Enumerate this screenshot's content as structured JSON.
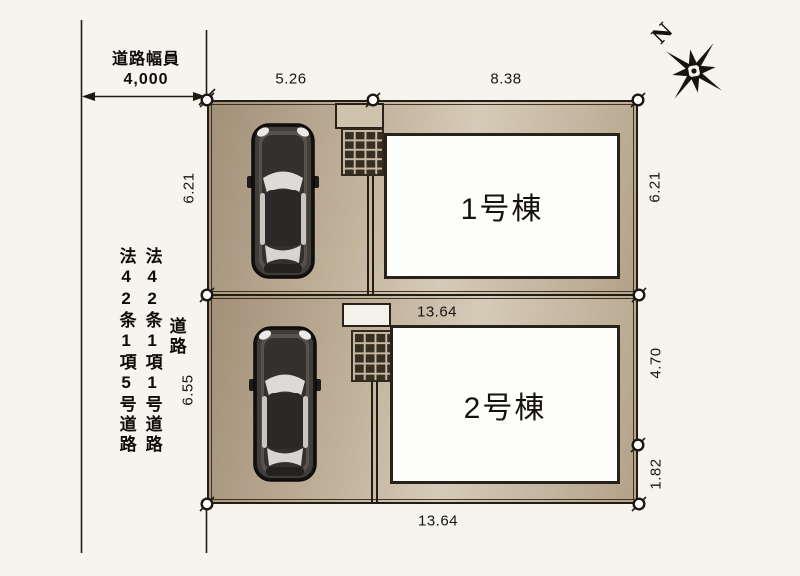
{
  "labels": {
    "road_width_caption": "道路幅員",
    "road_vertical": "道路",
    "law_note_col1": "法42条1項5号道路",
    "law_note_col2": "法42条1項1号道路",
    "building1": "1号棟",
    "building2": "2号棟",
    "north": "N"
  },
  "dimensions": {
    "road_width": "4,000",
    "top_left": "5.26",
    "top_right": "8.38",
    "lot1_left": "6.21",
    "lot1_right": "6.21",
    "lot2_left": "6.55",
    "lot2_width_top": "13.64",
    "lot2_right_upper": "4.70",
    "lot2_right_lower": "1.82",
    "bottom_width": "13.64"
  },
  "colors": {
    "plot_tan": "#c3b49e",
    "line_dark": "#241d14",
    "building_fill": "#fdfdfb",
    "page_bg": "#f6f4ef"
  }
}
